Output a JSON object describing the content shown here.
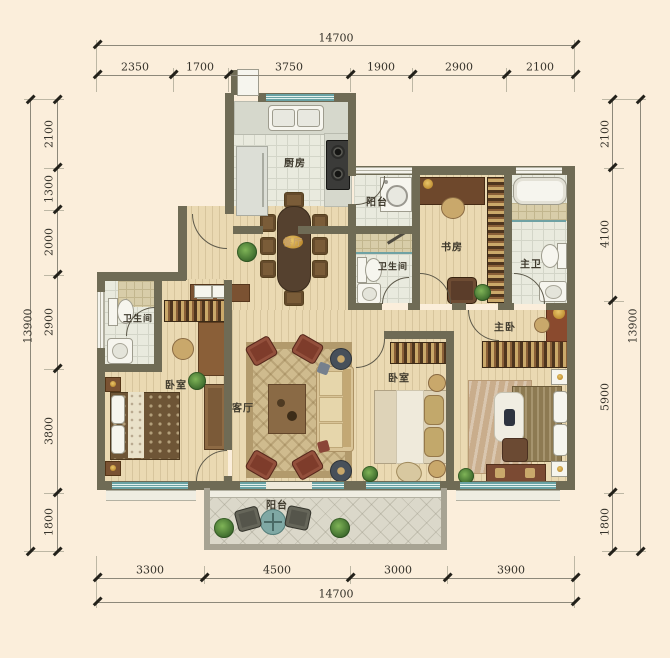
{
  "title": "apartment-floor-plan",
  "dims": {
    "top": {
      "total": "14700",
      "segs": [
        "2350",
        "1700",
        "3750",
        "1900",
        "2900",
        "2100"
      ]
    },
    "bottom": {
      "total": "14700",
      "segs": [
        "3300",
        "4500",
        "3000",
        "3900"
      ]
    },
    "left": {
      "total": "13900",
      "segs": [
        "2100",
        "1300",
        "2000",
        "2900",
        "3800",
        "1800"
      ]
    },
    "right": {
      "total": "13900",
      "segs": [
        "2100",
        "4100",
        "5900",
        "1800"
      ]
    }
  },
  "rooms": {
    "kitchen": "厨房",
    "dining": "餐厅",
    "living": "客厅",
    "study": "书房",
    "master_bedroom": "主卧",
    "master_bath": "主卫",
    "bedroom_left": "卧室",
    "bedroom_mid": "卧室",
    "bath_left": "卫生间",
    "bath_mid": "卫生间",
    "balcony_top": "阳台",
    "balcony_bottom": "阳台"
  },
  "colors": {
    "background": "#fbeedb",
    "wall": "#6f6b55",
    "balcony_wall": "#a7a393",
    "wood_floor": "#ead9b2",
    "tile_floor": "#e9eade",
    "window_glass": "#69a2a4",
    "dining_table": "#55412f",
    "accent_red_chair": "#7e3c2b",
    "label_text": "#3e392c",
    "dim_text": "#35322a"
  }
}
